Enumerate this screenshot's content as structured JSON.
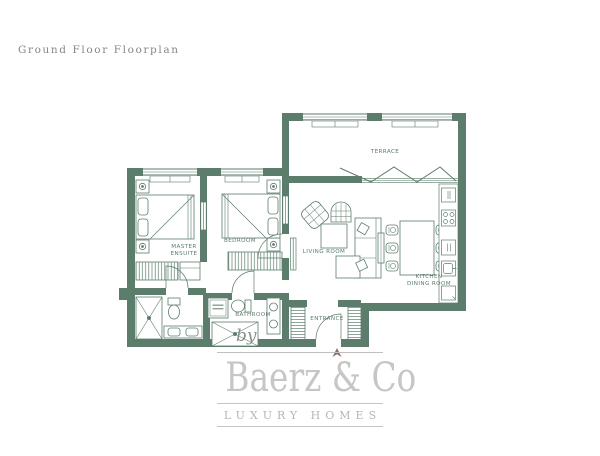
{
  "page_title": "Ground Floor Floorplan",
  "floorplan": {
    "rooms": {
      "terrace": "TERRACE",
      "master_ensuite_line1": "MASTER",
      "master_ensuite_line2": "ENSUITE",
      "bedroom": "BEDROOM",
      "living_room": "LIVING ROOM",
      "kitchen_dining_line1": "KITCHEN",
      "kitchen_dining_line2": "DINING ROOM",
      "bathroom": "BATHROOM",
      "entrance": "ENTRANCE"
    },
    "colors": {
      "wall": "#5d7d6c",
      "label": "#5d7d6c",
      "north_arrow": "#8d7164"
    }
  },
  "branding": {
    "by": "by",
    "name": "Baerz & Co",
    "tagline": "LUXURY HOMES",
    "colors": {
      "logo_text": "#c7c6c4",
      "title_text": "#8b8580"
    }
  }
}
